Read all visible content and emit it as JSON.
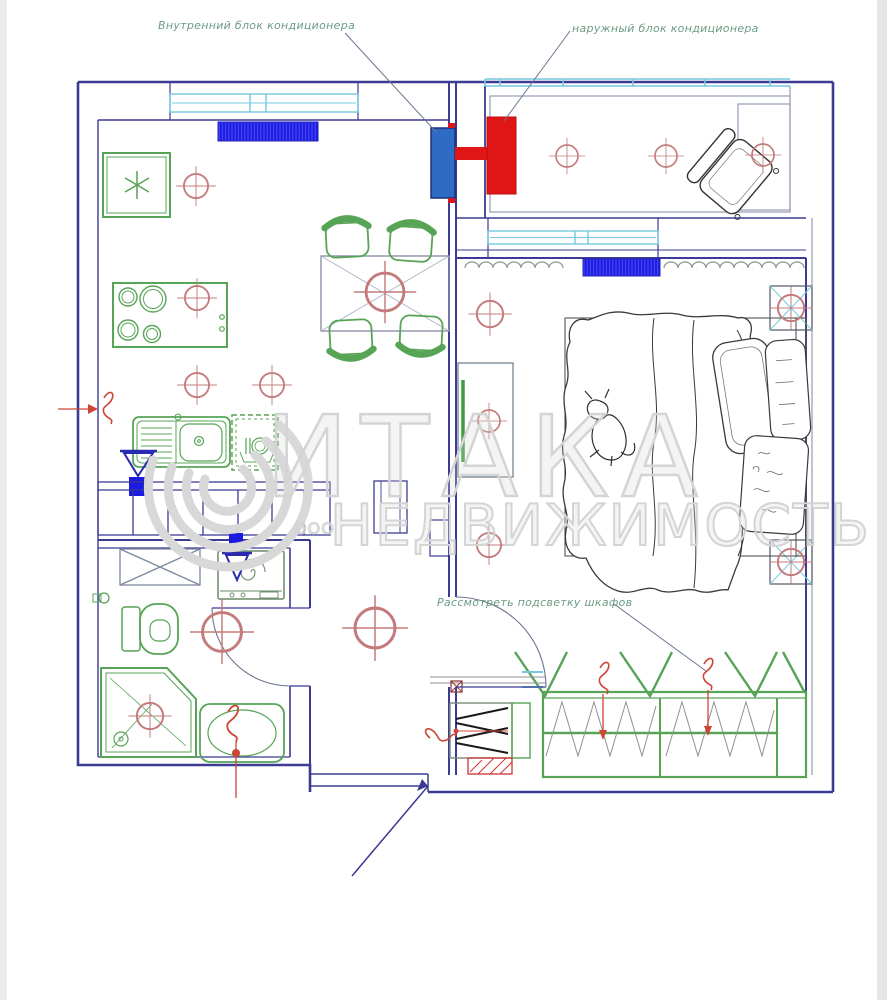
{
  "annotations": {
    "indoor_ac": "Внутренний блок кондиционера",
    "outdoor_ac": "наружный блок кондиционера",
    "wardrobe_lighting": "Рассмотреть подсветку шкафов"
  },
  "watermark": {
    "company_form": "ООО",
    "brand": "ИТАКА",
    "word": "НЕДВИЖИМОСТЬ"
  },
  "colors": {
    "wall_blue": "#3b3b94",
    "furniture_green": "#57a457",
    "accent_red": "#e01515",
    "accent_blue": "#1a1ae0",
    "light_circle_red": "#c47b7b",
    "window_cyan": "#74c8dc",
    "annotation_green": "#6b9c84",
    "watermark_gray": "#d4d4d4"
  },
  "fixtures": {
    "kitchen": [
      "fridge",
      "cooktop",
      "sink",
      "dishwasher",
      "counter",
      "dining-table",
      "chairs"
    ],
    "bathroom": [
      "cabinet",
      "washing-machine",
      "toilet",
      "shower",
      "washbasin"
    ],
    "bedroom": [
      "bed",
      "nightstands",
      "tv-stand",
      "wardrobe",
      "shoe-cabinet"
    ],
    "balcony": [
      "armchair",
      "rug"
    ],
    "equipment": [
      "indoor-ac-unit",
      "outdoor-ac-unit",
      "radiators",
      "ceiling-lights",
      "water-valves"
    ]
  }
}
